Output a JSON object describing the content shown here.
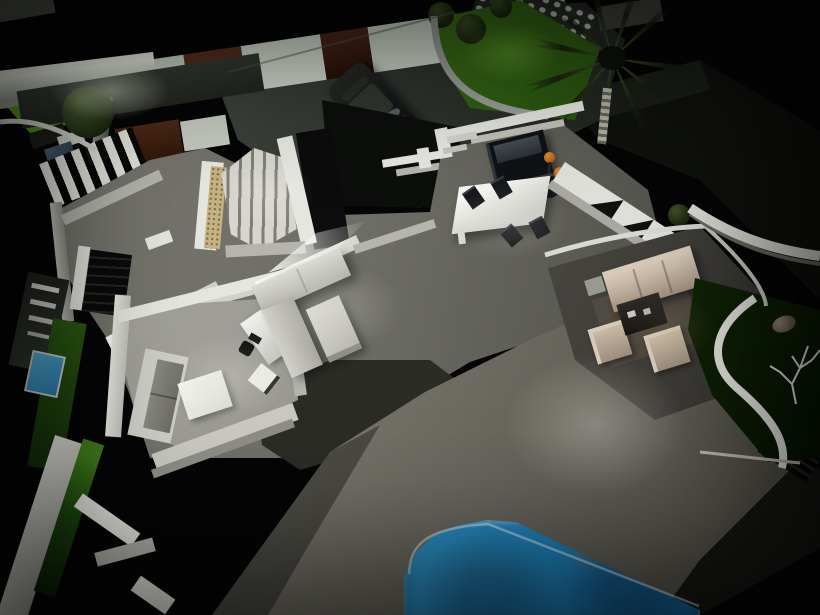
{
  "scene": {
    "type": "3d-architectural-night-render",
    "view": "aerial-dollhouse-night",
    "palette": {
      "night": "#050505",
      "wall-white": "#e6e6e0",
      "wall-shadow": "#b5b5ae",
      "floor-grey": "#6d6d66",
      "office-floor": "#a6a69e",
      "terrace-light": "#98968c",
      "terrace-dark": "#504e46",
      "covered-floor": "#4a4843",
      "pool-blue": "#2f93c6",
      "pool-deep": "#14639a",
      "grass-bright": "#63a026",
      "grass-dark": "#0f2406",
      "wood-brown": "#4e2a16",
      "pebble-tan": "#c4b184",
      "sofa-black": "#101316",
      "cushion-grey": "#454c54",
      "stool-orange": "#e08a30",
      "lounge-beige": "#c9baa8",
      "water-blue": "#53b5e2",
      "palm-frond": "#3a4a2c",
      "rock-grey": "#b9c0b6",
      "car-body": "#15181a",
      "driveway": "#343a33",
      "topiary-green": "#1a250f",
      "rug-white": "#f4f4f0"
    },
    "objects": [
      "perimeter-wall",
      "wood-wall-panels",
      "driveway",
      "parked-car",
      "topiary-tree",
      "front-lawn",
      "rock-wall",
      "shrubs",
      "palm-tree",
      "staircase-up",
      "pebble-border",
      "staircase-down",
      "interior-floor",
      "kitchen-shelves",
      "kitchen-sofa",
      "bar-stools",
      "dining-table",
      "dining-chairs",
      "sectional-sofa",
      "coffee-table",
      "partition-wall",
      "office-sofa",
      "rug",
      "desk",
      "office-chair",
      "side-chair",
      "entry-wall-openings",
      "covered-terrace",
      "outdoor-lounge-set",
      "terrace",
      "swimming-pool",
      "side-garden",
      "dead-tree-sculpture",
      "boulder",
      "water-feature",
      "glass-balustrade",
      "garden-walkway"
    ]
  }
}
